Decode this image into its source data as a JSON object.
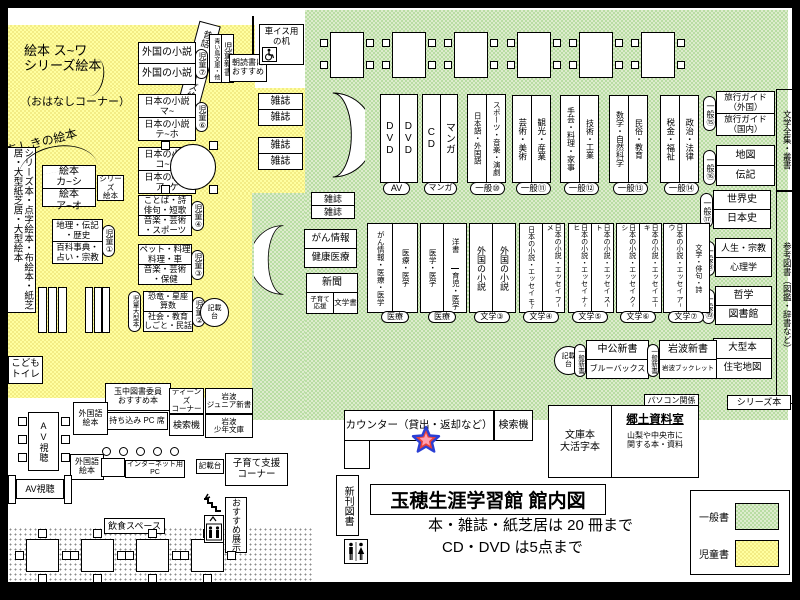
{
  "title": {
    "main": "玉穂生涯学習館 館内図",
    "note1": "本・雑誌・紙芝居は 20 冊まで",
    "note2": "CD・DVD は5点まで"
  },
  "legend": {
    "general_label": "一般書",
    "children_label": "児童書",
    "general_color": "#ddeccd",
    "children_color": "#ffffa0",
    "search_color": "#f9a3c4"
  },
  "icons": {
    "wheelchair": "wheelchair-icon",
    "restroom": "restroom-icon",
    "stairs": "stairs-icon",
    "elevator": "elevator-icon",
    "star": "star-marker-icon",
    "curved_shelf_right": "curved-shelf",
    "curved_shelf_left": "curved-shelf"
  },
  "elements": {
    "ehon_heading": {
      "lines": [
        "絵本 ス~ワ",
        "シリーズ絵本"
      ]
    },
    "ohanashi": {
      "text": "（おはなしコーナー）"
    },
    "mukashibanashi": {
      "text": "昔話・シリーズ絵本"
    },
    "chishiki": {
      "text": "ちしきの絵本"
    },
    "series_tenji": {
      "text": "シリーズ本・点字絵本・布絵本・紙芝居・大型紙芝居・大型絵本"
    },
    "ehon_ka_shi": {
      "rows": [
        [
          "絵本",
          "カ~シ"
        ],
        [
          "絵本",
          "ア~オ"
        ]
      ]
    },
    "series_ehon_small": {
      "lines": [
        "シリーズ",
        "絵本"
      ]
    },
    "geography": {
      "rows": [
        [
          "地理・伝記",
          "・歴史"
        ],
        [
          "百科事典・",
          "占い・宗教"
        ]
      ]
    },
    "jido1": {
      "text": "児童①"
    },
    "kids_toilet": {
      "lines": [
        "こども",
        "トイレ"
      ]
    },
    "foreign_novels_kids": {
      "rows": [
        [
          "外国の小説"
        ],
        [
          "外国の小説"
        ]
      ]
    },
    "jido7": {
      "text": "児童⑦"
    },
    "aoitori": {
      "cols": [
        "青い鳥文庫・他",
        "児童新書"
      ]
    },
    "asadoku": {
      "lines": [
        "朝読書に",
        "おすすめ"
      ]
    },
    "jnovels_ma": {
      "rows": [
        [
          "日本の小説",
          "マ~"
        ],
        [
          "日本の小説",
          "テ~ホ"
        ]
      ]
    },
    "jido6": {
      "text": "児童⑥"
    },
    "jnovels_ko": {
      "rows": [
        [
          "日本の小説",
          "コ~ツ"
        ],
        [
          "日本の小説",
          "ア~ケ"
        ]
      ]
    },
    "jido5": {
      "text": "児童⑤"
    },
    "kotoba": {
      "rows": [
        [
          "ことば・詩",
          "俳句・短歌"
        ],
        [
          "音楽・芸術",
          "・スポーツ"
        ]
      ]
    },
    "jido4": {
      "text": "児童④"
    },
    "pets": {
      "rows": [
        [
          "ペット・料理",
          "料理・車"
        ],
        [
          "音楽・芸術",
          "・保健"
        ]
      ]
    },
    "jido3": {
      "text": "児童③"
    },
    "dino": {
      "rows": [
        [
          "恐竜・星座",
          "算数"
        ],
        [
          "社会・教育",
          "しごと・民話"
        ]
      ]
    },
    "jido2": {
      "text": "児童②"
    },
    "jido_ogata": {
      "text": "児童大型本"
    },
    "kisaidai1": {
      "lines": [
        "記載",
        "台"
      ]
    },
    "mag1": {
      "rows": [
        [
          "雑誌"
        ],
        [
          "雑誌"
        ]
      ]
    },
    "mag2": {
      "rows": [
        [
          "雑誌"
        ],
        [
          "雑誌"
        ]
      ]
    },
    "mag3": {
      "rows": [
        [
          "雑誌"
        ],
        [
          "雑誌"
        ]
      ]
    },
    "wheelchair_desk": {
      "lines": [
        "車イス用",
        "の机"
      ]
    },
    "cancer_info": {
      "rows": [
        [
          "がん情報"
        ],
        [
          "健康医療"
        ]
      ]
    },
    "newspaper": {
      "top": "新聞",
      "left": [
        "子育て",
        "応援"
      ],
      "right": "文学書"
    },
    "dvd": {
      "cols": [
        "DVD",
        "DVD"
      ]
    },
    "badge_av": {
      "text": "AV"
    },
    "cd": {
      "cols": [
        "CD",
        "マンガ"
      ]
    },
    "badge_manga": {
      "text": "マンガ"
    },
    "lang": {
      "cols": [
        "日本語・外国語",
        "スポーツ・音楽・演劇"
      ]
    },
    "g10": {
      "text": "一般⑩"
    },
    "art": {
      "cols": [
        "芸術・美術",
        "観光・産業"
      ]
    },
    "g11": {
      "text": "一般⑪"
    },
    "craft": {
      "cols": [
        "手芸・料理・家事",
        "技術・工業"
      ]
    },
    "g12": {
      "text": "一般⑫"
    },
    "math": {
      "cols": [
        "数学・自然科学",
        "民俗・教育"
      ]
    },
    "g13": {
      "text": "一般⑬"
    },
    "tax": {
      "cols": [
        "税金・福祉",
        "政治・法律"
      ]
    },
    "g14": {
      "text": "一般⑭"
    },
    "travel": {
      "rows": [
        [
          "旅行ガイド",
          "（外国）"
        ],
        [
          "旅行ガイド",
          "（国内）"
        ]
      ]
    },
    "g15": {
      "text": "一般⑮"
    },
    "map_bio": {
      "rows": [
        [
          "地図"
        ],
        [
          "伝記"
        ]
      ]
    },
    "g16": {
      "text": "一般⑯"
    },
    "world_history": {
      "rows": [
        [
          "世界史"
        ],
        [
          "日本史"
        ]
      ]
    },
    "g17": {
      "text": "一般⑰"
    },
    "life_religion": {
      "rows": [
        [
          "人生・宗教"
        ],
        [
          "心理学"
        ]
      ]
    },
    "g18": {
      "text": "一般⑱"
    },
    "philosophy": {
      "rows": [
        [
          "哲学"
        ],
        [
          "図書館"
        ]
      ]
    },
    "g19": {
      "text": "一般⑲"
    },
    "large_books": {
      "rows": [
        [
          "大型本"
        ],
        [
          "住宅地図"
        ]
      ]
    },
    "lit_complete": {
      "text": "文学全集・叢書"
    },
    "reference": {
      "text": "参考図書（図鑑・辞書など）"
    },
    "series_label": {
      "text": "シリーズ本"
    },
    "med1": {
      "cols": [
        "がん情報・医療・医学",
        "医療・医学"
      ]
    },
    "med1_badge": {
      "text": "医療"
    },
    "med2": {
      "cols": [
        "医学・医学",
        {
          "rows": [
            "洋書",
            "育児・医学"
          ]
        }
      ]
    },
    "med2_badge": {
      "text": "医療"
    },
    "flit3": {
      "cols": [
        "外国の小説",
        "外国の小説"
      ]
    },
    "f3": {
      "text": "文学③"
    },
    "flit4": {
      "cols": [
        "日本の小説・エッセイ モ~",
        "日本の小説・エッセイ フ~メ"
      ]
    },
    "f4": {
      "text": "文学④"
    },
    "flit5": {
      "cols": [
        "日本の小説・エッセイ ナ~ヒ",
        "日本の小説・エッセイ ス~ト"
      ]
    },
    "f5": {
      "text": "文学⑤"
    },
    "flit6": {
      "cols": [
        "日本の小説・エッセイ ク~シ",
        "日本の小説・エッセイ エ~キ"
      ]
    },
    "f6": {
      "text": "文学⑥"
    },
    "flit7": {
      "cols": [
        "日本の小説・エッセイ ア~ウ",
        "文学・俳句・詩"
      ]
    },
    "f7": {
      "text": "文学⑦"
    },
    "kisaidai2": {
      "lines": [
        "記載",
        "台"
      ]
    },
    "shinsho1": {
      "text": "一般新書"
    },
    "chuko": {
      "rows": [
        [
          "中公新書"
        ],
        [
          "ブルーバックス"
        ]
      ]
    },
    "shinsho2": {
      "text": "一般新書"
    },
    "iwanami": {
      "rows": [
        [
          "岩波新書"
        ],
        [
          "岩波ブックレット"
        ]
      ]
    },
    "pasokon": {
      "text": "パソコン関係"
    },
    "counter": {
      "text": "カウンター（貸出・返却など）"
    },
    "kensaku1": {
      "text": "検索機"
    },
    "bunko": {
      "left": [
        "文庫本",
        "大活字本"
      ],
      "right_title": "郷土資料室",
      "right_sub": [
        "山梨や中央市に",
        "関する本・資料"
      ]
    },
    "shinkan": {
      "text": "新刊図書"
    },
    "tama_osusume": {
      "lines": [
        "玉中図書委員",
        "おすすめ本"
      ]
    },
    "teens": {
      "lines": [
        "ティーンズ",
        "コーナー"
      ]
    },
    "iwa_junior": {
      "lines": [
        "岩波",
        "ジュニア新書"
      ]
    },
    "kensaku2": {
      "text": "検索機"
    },
    "iwa_shonen": {
      "lines": [
        "岩波",
        "少年文庫"
      ]
    },
    "pc_seat": {
      "text": "持ち込み PC 席"
    },
    "gaikoku1": {
      "lines": [
        "外国語",
        "絵本"
      ]
    },
    "gaikoku2": {
      "lines": [
        "外国語",
        "絵本"
      ]
    },
    "av1": {
      "text": "AV視聴"
    },
    "av2": {
      "text": "AV視聴"
    },
    "netpc": {
      "text": "インターネット用PC"
    },
    "kisaidai3": {
      "text": "記載台"
    },
    "kosodate": {
      "lines": [
        "子育て支援",
        "コーナー"
      ]
    },
    "osusume_tenji": {
      "text": "おすすめ展示"
    },
    "inshoku": {
      "text": "飲食スペース"
    }
  }
}
